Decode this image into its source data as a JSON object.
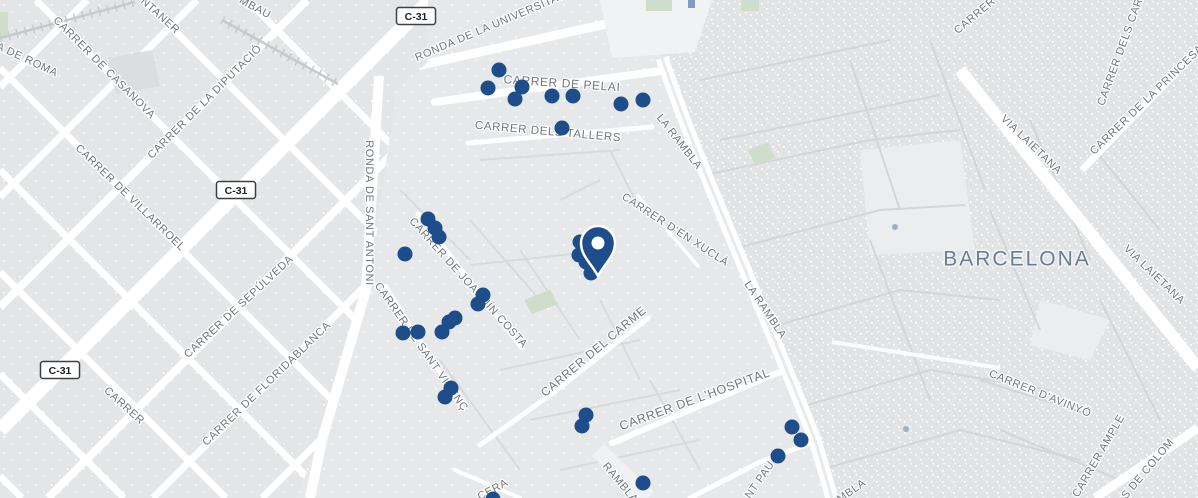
{
  "map": {
    "city_label": {
      "text": "BARCELONA"
    },
    "colors": {
      "land": "#e9eaec",
      "block_old_town": "#e1e3e4",
      "block_eixample": "#e3e5e6",
      "block_raval": "#e6e8e9",
      "road": "#ffffff",
      "minor_road": "#d3d6d8",
      "railway": "#c7cacd",
      "park": "#cfdecb",
      "plaza": "#f1f2f3",
      "street_label": "#70777d",
      "city_label": "#6e7d92",
      "marker": "#1d4d8a",
      "badge_border": "#3c4043",
      "poi": "#9fb0c2"
    },
    "route_badges": [
      {
        "label": "C-31",
        "x": 416,
        "y": 16
      },
      {
        "label": "C-31",
        "x": 236,
        "y": 190
      },
      {
        "label": "C-31",
        "x": 60,
        "y": 370
      }
    ],
    "street_labels": [
      {
        "text": "A DE ROMA",
        "x": 27,
        "y": 60,
        "rot": 25
      },
      {
        "text": "CARRER DE CASANOVA",
        "x": 104,
        "y": 68,
        "rot": 45
      },
      {
        "text": "NTANER",
        "x": 160,
        "y": 16,
        "rot": 42
      },
      {
        "text": "MBAU",
        "x": 255,
        "y": 8,
        "rot": 28
      },
      {
        "text": "CARRER DE LA DIPUTACIÓ",
        "x": 205,
        "y": 102,
        "rot": -45
      },
      {
        "text": "CARRER DE VILLARROEL",
        "x": 130,
        "y": 198,
        "rot": 44
      },
      {
        "text": "CARRER DE SEPÚLVEDA",
        "x": 239,
        "y": 307,
        "rot": -43
      },
      {
        "text": "CARRER DE FLORIDABLANCA",
        "x": 267,
        "y": 384,
        "rot": -44
      },
      {
        "text": "CARRER",
        "x": 124,
        "y": 406,
        "rot": 42
      },
      {
        "text": "RONDA DE SANT ANTONI",
        "x": 369,
        "y": 213,
        "rot": 90
      },
      {
        "text": "RONDA DE LA UNIVERSITAT",
        "x": 490,
        "y": 27,
        "rot": -23
      },
      {
        "text": "CARRER DE PELAI",
        "x": 562,
        "y": 84,
        "rot": 4,
        "size": 12
      },
      {
        "text": "CARRER DELS TALLERS",
        "x": 548,
        "y": 132,
        "rot": 5,
        "size": 11.5
      },
      {
        "text": "LA RAMBLA",
        "x": 679,
        "y": 142,
        "rot": 52
      },
      {
        "text": "CARRER D'EN XUCLÀ",
        "x": 675,
        "y": 230,
        "rot": 33
      },
      {
        "text": "CARRER DE JOAQUÍN COSTA",
        "x": 468,
        "y": 283,
        "rot": 48
      },
      {
        "text": "LA RAMBLA",
        "x": 765,
        "y": 310,
        "rot": 56
      },
      {
        "text": "CARRER DE SANT VICENÇ",
        "x": 421,
        "y": 347,
        "rot": 55
      },
      {
        "text": "CARRER DEL CARME",
        "x": 594,
        "y": 352,
        "rot": -40,
        "size": 12
      },
      {
        "text": "CARRER DE L'HOSPITAL",
        "x": 695,
        "y": 400,
        "rot": -20,
        "size": 12.5
      },
      {
        "text": "RAMBLA",
        "x": 620,
        "y": 483,
        "rot": 50
      },
      {
        "text": "CERA",
        "x": 493,
        "y": 490,
        "rot": -28
      },
      {
        "text": "NT PAU",
        "x": 760,
        "y": 480,
        "rot": -55
      },
      {
        "text": "RAMBLA",
        "x": 845,
        "y": 496,
        "rot": -35
      },
      {
        "text": "CARRER",
        "x": 975,
        "y": 16,
        "rot": -40
      },
      {
        "text": "CARRER DELS CARD",
        "x": 1122,
        "y": 48,
        "rot": -70
      },
      {
        "text": "VIA LAIETANA",
        "x": 1031,
        "y": 145,
        "rot": 44
      },
      {
        "text": "CARRER DE LA PRINCESA",
        "x": 1147,
        "y": 100,
        "rot": -44
      },
      {
        "text": "VIA LAIETANA",
        "x": 1154,
        "y": 275,
        "rot": 44
      },
      {
        "text": "CARRER D'AVINYÓ",
        "x": 1040,
        "y": 394,
        "rot": 22
      },
      {
        "text": "CARRER AMPLE",
        "x": 1099,
        "y": 456,
        "rot": -60
      },
      {
        "text": "S DE COLOM",
        "x": 1148,
        "y": 469,
        "rot": -50
      }
    ],
    "markers": {
      "pin": {
        "x": 598,
        "y": 276
      },
      "dots": [
        [
          499,
          70
        ],
        [
          488,
          88
        ],
        [
          522,
          87
        ],
        [
          515,
          99
        ],
        [
          552,
          96
        ],
        [
          573,
          96
        ],
        [
          621,
          104
        ],
        [
          643,
          100
        ],
        [
          562,
          128
        ],
        [
          428,
          219
        ],
        [
          435,
          228
        ],
        [
          439,
          237
        ],
        [
          405,
          254
        ],
        [
          580,
          242
        ],
        [
          579,
          255
        ],
        [
          586,
          262
        ],
        [
          591,
          273
        ],
        [
          483,
          295
        ],
        [
          478,
          304
        ],
        [
          455,
          318
        ],
        [
          449,
          322
        ],
        [
          442,
          332
        ],
        [
          418,
          332
        ],
        [
          403,
          333
        ],
        [
          451,
          388
        ],
        [
          445,
          397
        ],
        [
          586,
          415
        ],
        [
          582,
          426
        ],
        [
          643,
          483
        ],
        [
          493,
          499
        ],
        [
          792,
          427
        ],
        [
          801,
          440
        ],
        [
          778,
          456
        ]
      ],
      "dot_radius": 7.5,
      "poi_dots": [
        [
          906,
          429
        ],
        [
          895,
          227
        ]
      ]
    }
  }
}
